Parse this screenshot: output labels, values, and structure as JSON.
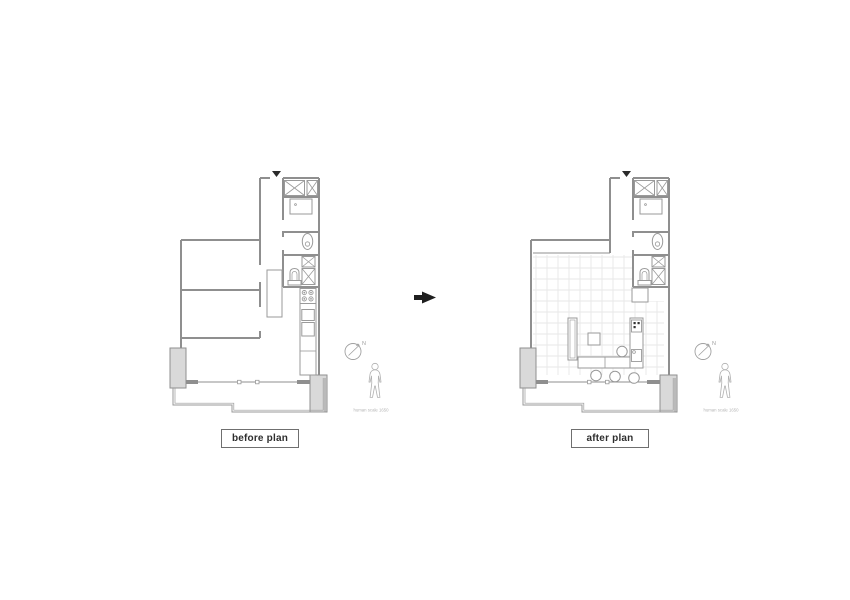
{
  "title": "floor plan comparison",
  "plans": {
    "before": {
      "label": "before plan",
      "north_label": "N",
      "human_caption": "human scale 1650"
    },
    "after": {
      "label": "after plan",
      "north_label": "N",
      "human_caption": "human scale 1650"
    }
  },
  "arrow": {
    "direction": "right"
  },
  "colors": {
    "background": "#ffffff",
    "wall": "#8f8f8f",
    "fixture": "#9a9a9a",
    "pillar_fill": "#d9d9d9",
    "tile": "#e7e7e7",
    "label_text": "#2e2e2e",
    "marker": "#2b2b2b",
    "annotation": "#b5b5b5",
    "north": "#a0a0a0"
  }
}
